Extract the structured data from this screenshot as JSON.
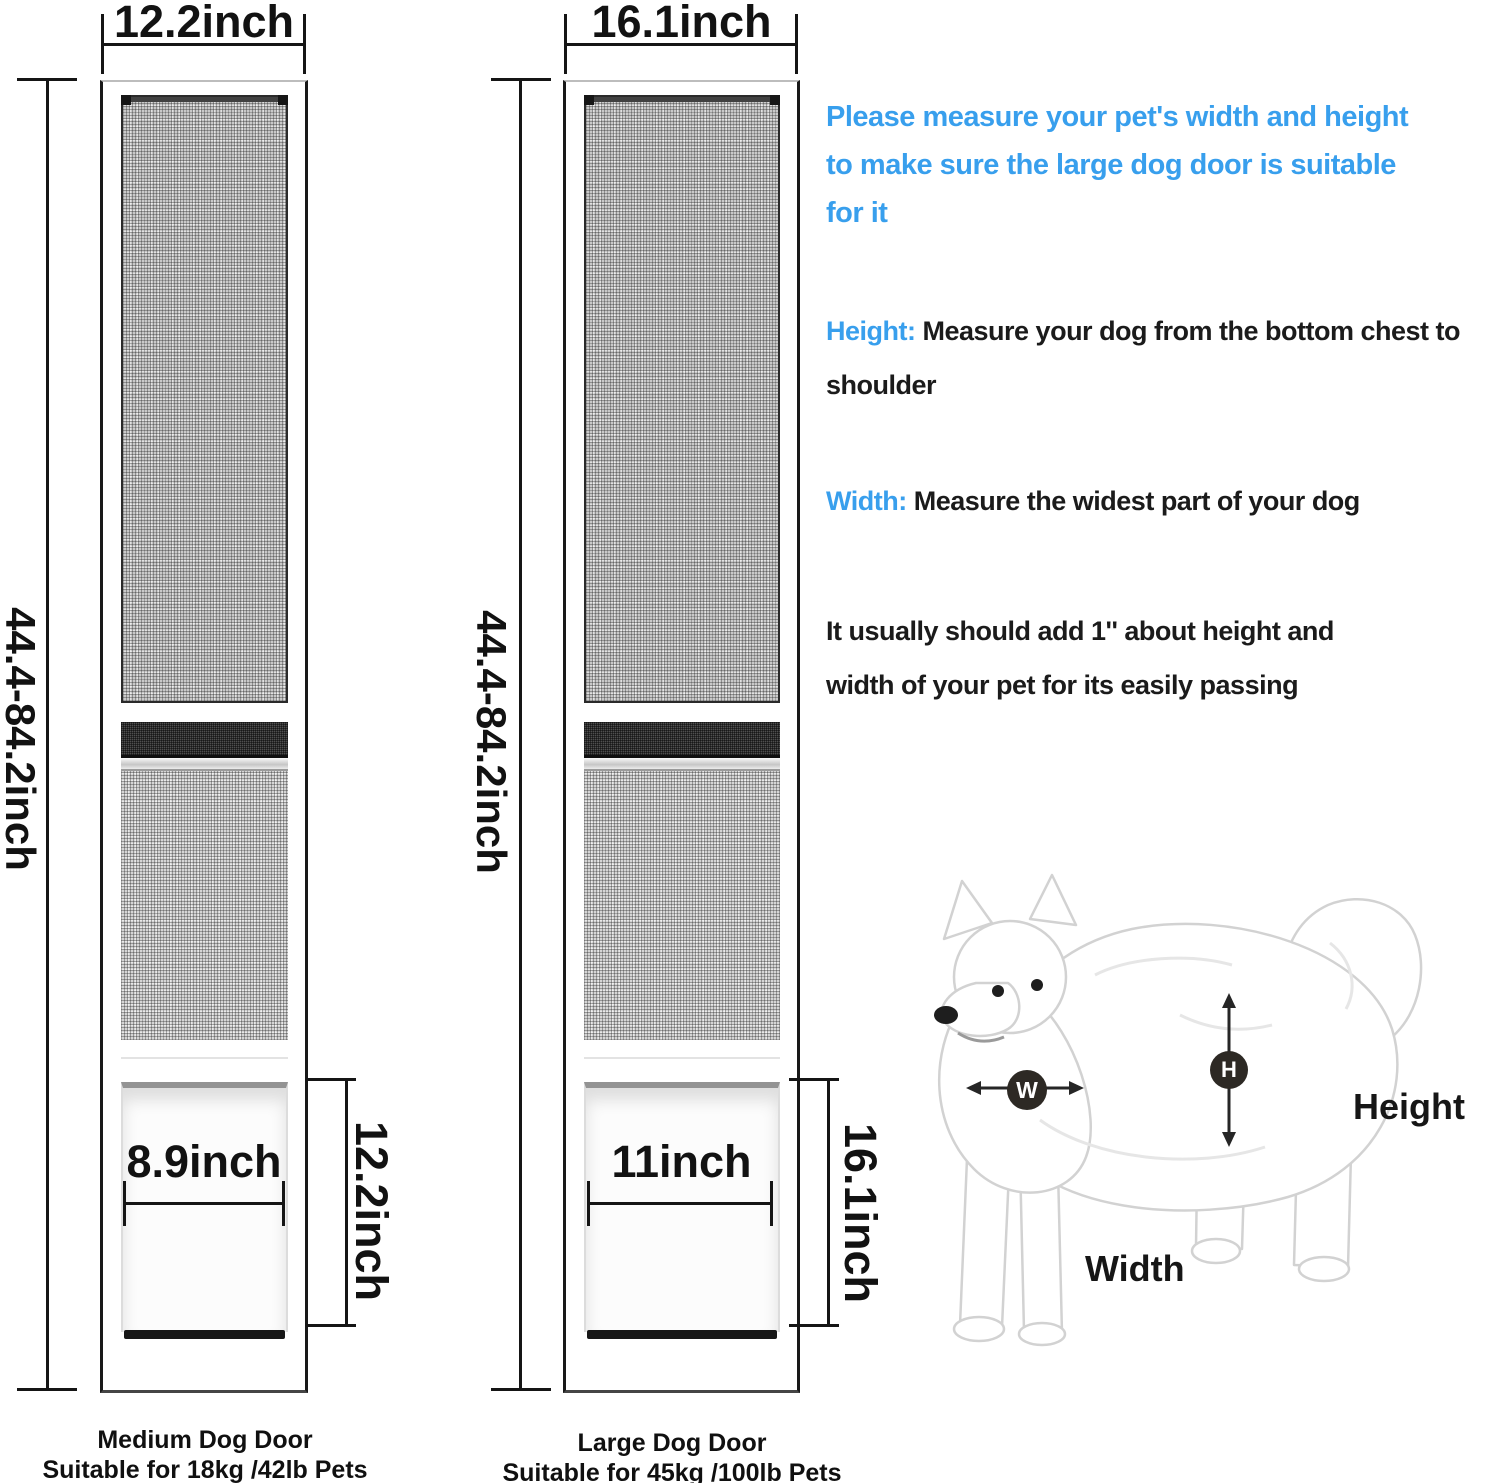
{
  "doors": [
    {
      "top_width_label": "12.2inch",
      "height_range_label": "44.4-84.2inch",
      "flap_width_label": "8.9inch",
      "flap_height_label": "12.2inch",
      "caption_line1": "Medium Dog Door",
      "caption_line2": "Suitable for 18kg /42lb Pets"
    },
    {
      "top_width_label": "16.1inch",
      "height_range_label": "44.4-84.2inch",
      "flap_width_label": "11inch",
      "flap_height_label": "16.1inch",
      "caption_line1": "Large Dog Door",
      "caption_line2": "Suitable for 45kg /100lb Pets"
    }
  ],
  "instructions": {
    "intro_lines": [
      "Please measure your pet's width and height",
      "to make sure the large dog door is suitable",
      "for it"
    ],
    "height_term": "Height:",
    "height_desc_lines": [
      "Measure your dog from the bottom chest to",
      "shoulder"
    ],
    "width_term": "Width:",
    "width_desc": "Measure the widest part of your dog",
    "note_lines": [
      "It usually should add 1'' about height and",
      "width of your pet for its easily passing"
    ]
  },
  "measure_diagram": {
    "w_badge": "W",
    "h_badge": "H",
    "height_label": "Height",
    "width_label": "Width"
  },
  "colors": {
    "accent_blue": "#389FED",
    "text_black": "#1b1b1b",
    "badge_dark": "#2D2924",
    "dimension_line": "#151515"
  }
}
